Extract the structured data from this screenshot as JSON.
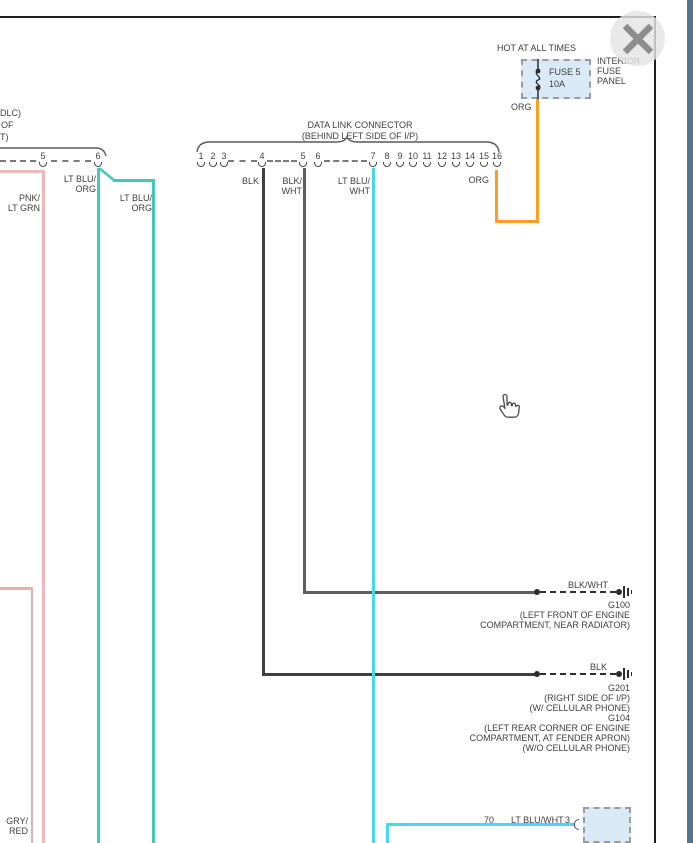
{
  "window": {
    "close_icon": "x-close",
    "scrollbar": "right-edge-scroll-strip"
  },
  "fuse_panel": {
    "hot_label": "HOT AT ALL TIMES",
    "fuse_name": "FUSE 5",
    "fuse_rating": "10A",
    "panel_label_lines": [
      "INTERIOR",
      "FUSE",
      "PANEL"
    ],
    "output_wire_color": "ORG"
  },
  "dlc": {
    "title": "DATA LINK CONNECTOR",
    "subtitle": "(BEHIND LEFT SIDE OF I/P)",
    "pins": [
      "1",
      "2",
      "3",
      "4",
      "5",
      "6",
      "7",
      "8",
      "9",
      "10",
      "11",
      "12",
      "13",
      "14",
      "15",
      "16"
    ],
    "pin4_wire": "BLK",
    "pin5_wire_l1": "BLK/",
    "pin5_wire_l2": "WHT",
    "pin7_wire_l1": "LT BLU/",
    "pin7_wire_l2": "WHT",
    "pin16_wire": "ORG"
  },
  "left_connector": {
    "label_fragment_1": "DLC)",
    "label_fragment_2": "OF",
    "label_fragment_3": "T)",
    "pin_a": "5",
    "pin_b": "6",
    "wire_pnk_l1": "PNK/",
    "wire_pnk_l2": "LT GRN",
    "wire_ltblu1_l1": "LT BLU/",
    "wire_ltblu1_l2": "ORG",
    "wire_ltblu2_l1": "LT BLU/",
    "wire_ltblu2_l2": "ORG",
    "wire_gry_l1": "GRY/",
    "wire_gry_l2": "RED"
  },
  "ground_g100": {
    "wire_label": "BLK/WHT",
    "id": "G100",
    "location_l1": "(LEFT FRONT OF ENGINE",
    "location_l2": "COMPARTMENT, NEAR RADIATOR)"
  },
  "ground_g201": {
    "wire_label": "BLK",
    "line1": "G201",
    "line2": "(RIGHT SIDE OF I/P)",
    "line3": "(W/ CELLULAR PHONE)",
    "line4": "G104",
    "line5": "(LEFT REAR CORNER OF ENGINE",
    "line6": "COMPARTMENT, AT FENDER APRON)",
    "line7": "(W/O CELLULAR PHONE)"
  },
  "bottom_connector": {
    "circuit_number": "70",
    "wire_color": "LT BLU/WHT",
    "pin_number": "3"
  },
  "colors": {
    "org": "#FF9D21",
    "lt_blu_wht": "#46D9EE",
    "lt_blu_org": "#43C9BC",
    "pnk_lt_grn": "#EFB6BB",
    "gry_red": "#E7B0AC",
    "blk": "#3F3F3F",
    "blk_wht": "#5E5E5E",
    "box_fill": "#D9E9F6",
    "scroll_strip": "#56748F",
    "border": "#1F1F1F"
  }
}
